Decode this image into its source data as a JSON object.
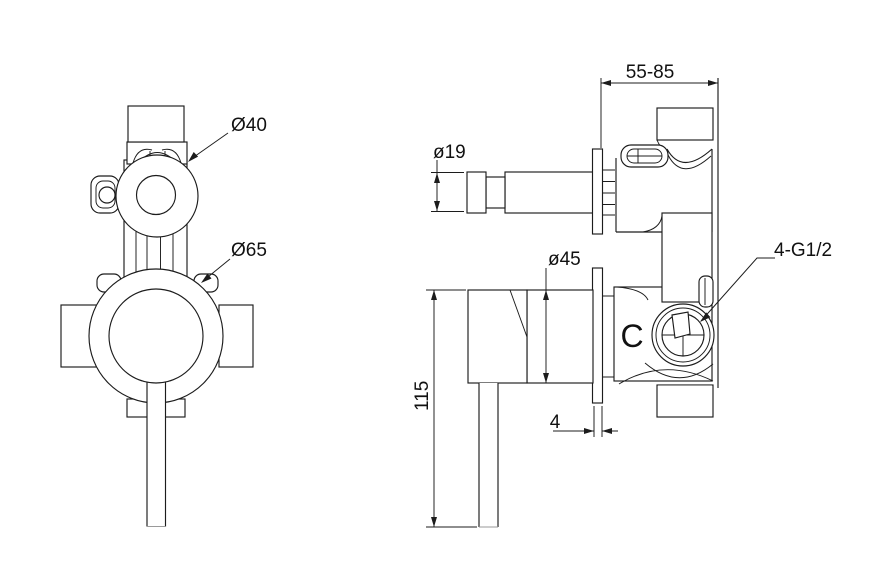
{
  "front_view": {
    "label_cap_diameter": "Ø40",
    "label_trim_diameter": "Ø65"
  },
  "side_view": {
    "label_spout_diameter": "ø19",
    "label_body_diameter": "ø45",
    "label_depth_range": "55-85",
    "label_height": "115",
    "label_plate_thickness": "4",
    "label_ports": "4-G1/2",
    "label_cold_marking": "C"
  }
}
